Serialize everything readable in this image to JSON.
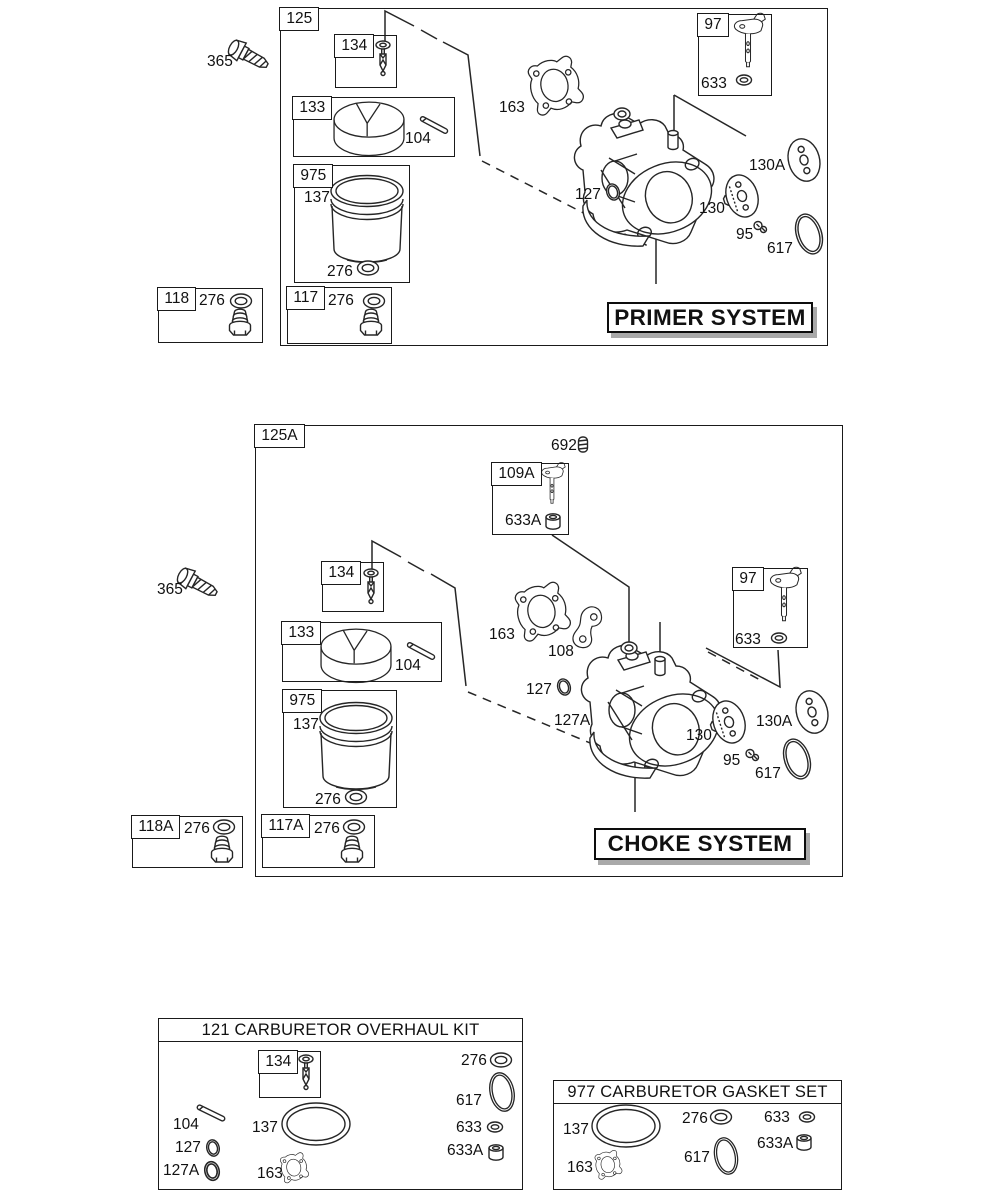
{
  "primer_system": {
    "section_tab": "125",
    "title": "PRIMER SYSTEM",
    "labels": {
      "p365": "365",
      "b134": "134",
      "b133": "133",
      "p104": "104",
      "b975": "975",
      "p137": "137",
      "p276": "276",
      "p163": "163",
      "p127": "127",
      "p130": "130",
      "p130a": "130A",
      "p95": "95",
      "p617": "617",
      "b97": "97",
      "p633": "633"
    },
    "inset_118": {
      "tab": "118",
      "p276": "276"
    },
    "inset_117": {
      "tab": "117",
      "p276": "276"
    }
  },
  "choke_system": {
    "section_tab": "125A",
    "title": "CHOKE SYSTEM",
    "labels": {
      "p365": "365",
      "p692": "692",
      "b109a": "109A",
      "p633a": "633A",
      "b134": "134",
      "b133": "133",
      "p104": "104",
      "b975": "975",
      "p137": "137",
      "p276": "276",
      "p163": "163",
      "p108": "108",
      "p127": "127",
      "p127a": "127A",
      "p130": "130",
      "p130a": "130A",
      "p95": "95",
      "p617": "617",
      "b97": "97",
      "p633": "633"
    },
    "inset_118a": {
      "tab": "118A",
      "p276": "276"
    },
    "inset_117a": {
      "tab": "117A",
      "p276": "276"
    }
  },
  "overhaul_kit": {
    "title": "121 CARBURETOR OVERHAUL KIT",
    "labels": {
      "b134": "134",
      "p104": "104",
      "p127": "127",
      "p127a": "127A",
      "p137": "137",
      "p163": "163",
      "p276": "276",
      "p617": "617",
      "p633": "633",
      "p633a": "633A"
    }
  },
  "gasket_set": {
    "title": "977 CARBURETOR GASKET SET",
    "labels": {
      "p137": "137",
      "p163": "163",
      "p276": "276",
      "p617": "617",
      "p633": "633",
      "p633a": "633A"
    }
  },
  "icons": {
    "365": "hex-bolt-icon",
    "134": "inlet-needle-icon",
    "133": "float-icon",
    "104": "float-hinge-pin-icon",
    "137": "float-bowl-icon",
    "276": "sealing-washer-icon",
    "163": "carburetor-gasket-icon",
    "127": "o-ring-icon",
    "127A": "o-ring-icon",
    "130": "primer-bulb-icon",
    "130A": "bulb-retainer-icon",
    "95": "retainer-screw-icon",
    "617": "large-o-ring-icon",
    "97": "choke-shaft-icon",
    "633": "shaft-washer-icon",
    "633A": "shaft-seal-cup-icon",
    "692": "spring-icon",
    "108": "choke-link-icon",
    "117": "bowl-nut-icon",
    "118": "bowl-nut-icon"
  },
  "colors": {
    "ink": "#262626",
    "shadow": "#a9a9a9",
    "background": "#ffffff"
  }
}
